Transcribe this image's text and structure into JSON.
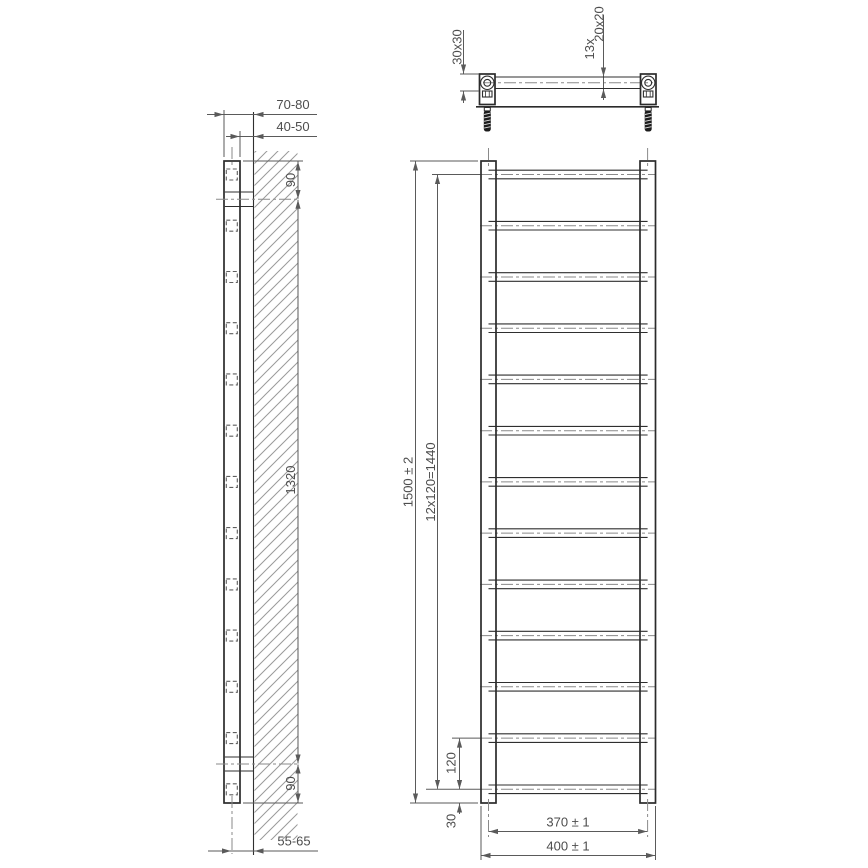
{
  "drawing": {
    "title": "towel-radiator-dimension-drawing",
    "side_view": {
      "wall_to_front": "70-80",
      "wall_to_back": "40-50",
      "top_bracket_offset": "90",
      "bracket_spacing": "1320",
      "bottom_bracket_offset": "90",
      "wall_to_axis": "55-65"
    },
    "top_view": {
      "post_profile": "30x30",
      "rung_count": "13x",
      "rung_profile": "20x20"
    },
    "front_view": {
      "overall_height": "1500 ± 2",
      "rung_pitch_total": "12x120=1440",
      "rung_pitch": "120",
      "bottom_rung_offset": "30",
      "axis_spacing": "370 ± 1",
      "overall_width": "400 ± 1"
    },
    "style": {
      "object_line_color": "#2b2b2b",
      "dimension_line_color": "#5a5a5a",
      "center_line_color": "#8a8a8a",
      "hatch_color": "#9a9a9a",
      "background": "#ffffff"
    }
  }
}
